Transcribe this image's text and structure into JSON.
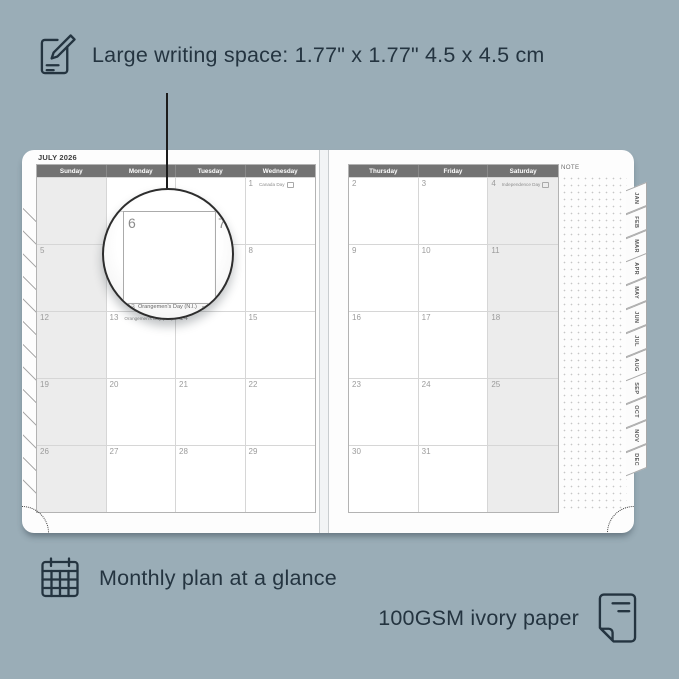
{
  "colors": {
    "background": "#9AADB7",
    "ink": "#243440",
    "page": "#FDFDFD",
    "header_bg": "#737373",
    "shaded_column": "#ECECEC",
    "grid_line": "#D6D6D6",
    "date_number": "#9B9B9B"
  },
  "annotations": {
    "writing_space": "Large writing space: 1.77\" x 1.77\" 4.5 x 4.5 cm",
    "monthly_plan": "Monthly plan at a glance",
    "paper": "100GSM ivory paper"
  },
  "planner": {
    "month_title": "JULY 2026",
    "note_label": "NOTE",
    "tabs": [
      "JAN",
      "FEB",
      "MAR",
      "APR",
      "MAY",
      "JUN",
      "JUL",
      "AUG",
      "SEP",
      "OCT",
      "NOV",
      "DEC"
    ],
    "left_page": {
      "headers": [
        "Sunday",
        "Monday",
        "Tuesday",
        "Wednesday"
      ],
      "shaded_col": 0,
      "rows": [
        [
          {
            "d": ""
          },
          {
            "d": ""
          },
          {
            "d": ""
          },
          {
            "d": "1",
            "h": "Canada Day"
          }
        ],
        [
          {
            "d": "5"
          },
          {
            "d": "6"
          },
          {
            "d": "7"
          },
          {
            "d": "8"
          }
        ],
        [
          {
            "d": "12"
          },
          {
            "d": "13",
            "h": "Orangemen's Day (N.I.)"
          },
          {
            "d": "14"
          },
          {
            "d": "15"
          }
        ],
        [
          {
            "d": "19"
          },
          {
            "d": "20"
          },
          {
            "d": "21"
          },
          {
            "d": "22"
          }
        ],
        [
          {
            "d": "26"
          },
          {
            "d": "27"
          },
          {
            "d": "28"
          },
          {
            "d": "29"
          }
        ]
      ]
    },
    "right_page": {
      "headers": [
        "Thursday",
        "Friday",
        "Saturday"
      ],
      "shaded_col": 2,
      "rows": [
        [
          {
            "d": "2"
          },
          {
            "d": "3"
          },
          {
            "d": "4",
            "h": "Independence Day"
          }
        ],
        [
          {
            "d": "9"
          },
          {
            "d": "10"
          },
          {
            "d": "11"
          }
        ],
        [
          {
            "d": "16"
          },
          {
            "d": "17"
          },
          {
            "d": "18"
          }
        ],
        [
          {
            "d": "23"
          },
          {
            "d": "24"
          },
          {
            "d": "25"
          }
        ],
        [
          {
            "d": "30"
          },
          {
            "d": "31"
          },
          {
            "d": ""
          }
        ]
      ]
    }
  },
  "magnifier": {
    "left_day": "6",
    "right_day": "7",
    "caption_date": "13",
    "caption": "Orangemen's Day (N.I.)"
  }
}
